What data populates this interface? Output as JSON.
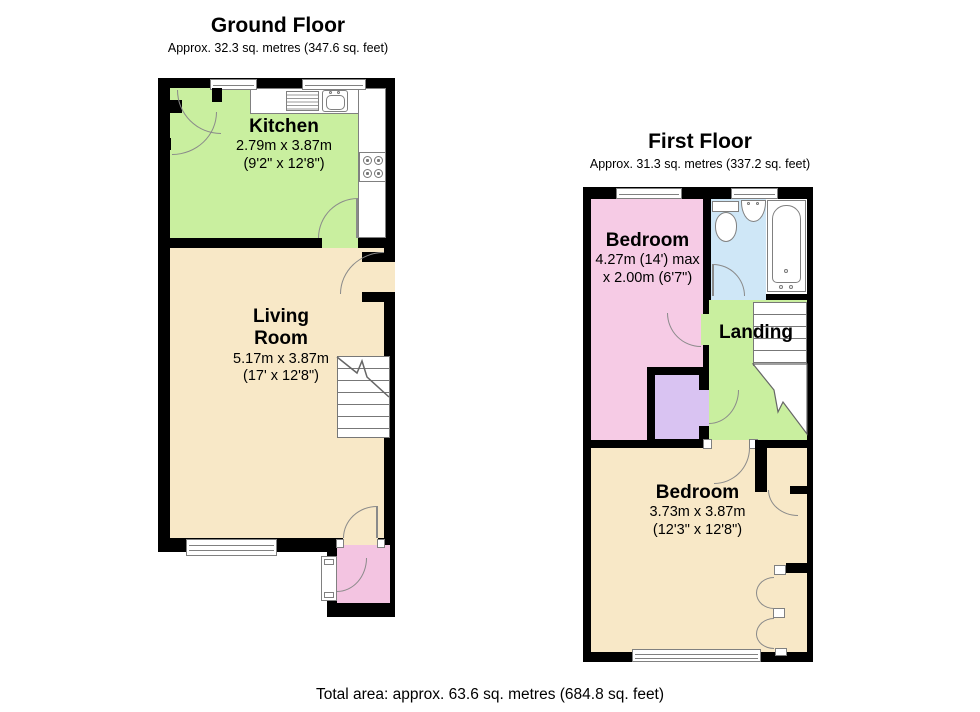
{
  "floors": {
    "ground": {
      "title": "Ground Floor",
      "subtitle": "Approx. 32.3 sq. metres (347.6 sq. feet)",
      "kitchen": {
        "name": "Kitchen",
        "dim_metric": "2.79m x 3.87m",
        "dim_imperial": "(9'2\" x 12'8\")",
        "color": "#c9ef9f"
      },
      "living_room": {
        "name": "Living Room",
        "dim_metric": "5.17m x 3.87m",
        "dim_imperial": "(17' x 12'8\")",
        "color": "#f8e8c7"
      },
      "porch": {
        "color": "#f3c4e1"
      }
    },
    "first": {
      "title": "First Floor",
      "subtitle": "Approx. 31.3 sq. metres (337.2 sq. feet)",
      "bedroom_front": {
        "name": "Bedroom",
        "dim_line1": "4.27m (14') max",
        "dim_line2": "x 2.00m (6'7\")",
        "color": "#f6cbe5"
      },
      "landing": {
        "name": "Landing",
        "color": "#c9ef9f"
      },
      "bedroom_back": {
        "name": "Bedroom",
        "dim_metric": "3.73m x 3.87m",
        "dim_imperial": "(12'3\" x 12'8\")",
        "color": "#f8e8c7"
      },
      "bathroom": {
        "color": "#cfe7f7"
      },
      "cupboard": {
        "color": "#d9c3f2"
      }
    }
  },
  "footer": {
    "total_area": "Total area: approx. 63.6 sq. metres (684.8 sq. feet)"
  },
  "palette": {
    "wall": "#000000",
    "fixture_line": "#808080",
    "door_arc": "#8a8a8a"
  }
}
